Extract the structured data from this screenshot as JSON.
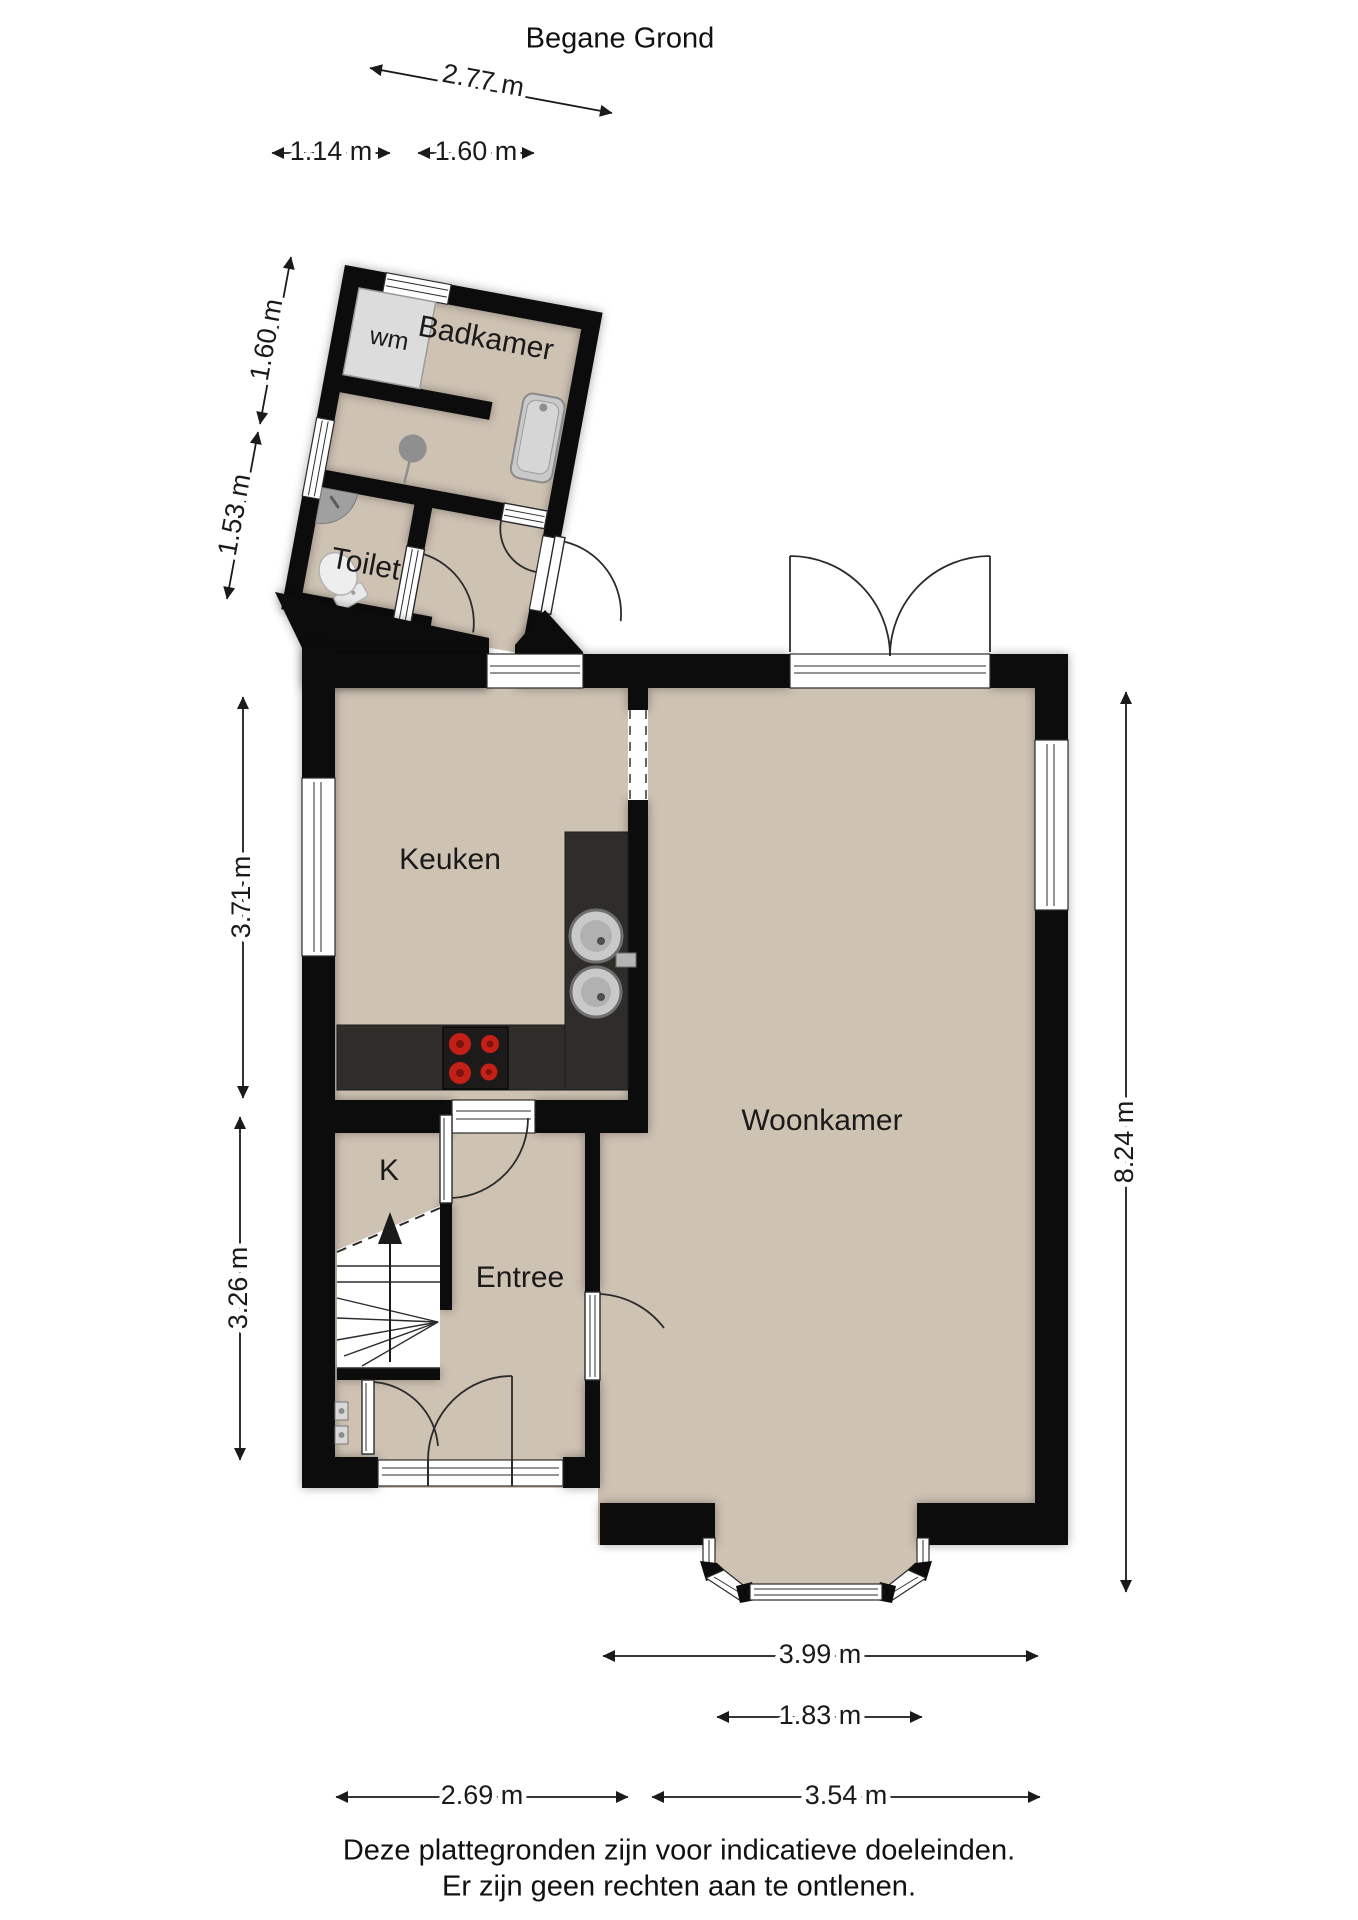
{
  "title": "Begane Grond",
  "rooms": {
    "badkamer": "Badkamer",
    "toilet": "Toilet",
    "keuken": "Keuken",
    "woonkamer": "Woonkamer",
    "entree": "Entree",
    "closet": "K",
    "washing_machine": "wm"
  },
  "dimensions": {
    "top_total": "2.77 m",
    "top_left": "1.14 m",
    "top_right": "1.60 m",
    "side_upper": "1.60 m",
    "side_mid": "1.53 m",
    "side_kitchen": "3.71 m",
    "side_lower": "3.26 m",
    "right_total": "8.24 m",
    "bottom_livingroom": "3.99 m",
    "bottom_bay": "1.83 m",
    "bottom_left": "2.69 m",
    "bottom_right": "3.54 m"
  },
  "footer": {
    "line1": "Deze plattegronden zijn voor indicatieve doeleinden.",
    "line2": "Er zijn geen rechten aan te ontlenen."
  },
  "colors": {
    "floor": "#cec2b3",
    "wall": "#0c0c0c",
    "counter": "#2f2d2a",
    "stove": "#1c1b1a",
    "burner": "#c32017",
    "fixture": "#d9d9d9"
  }
}
